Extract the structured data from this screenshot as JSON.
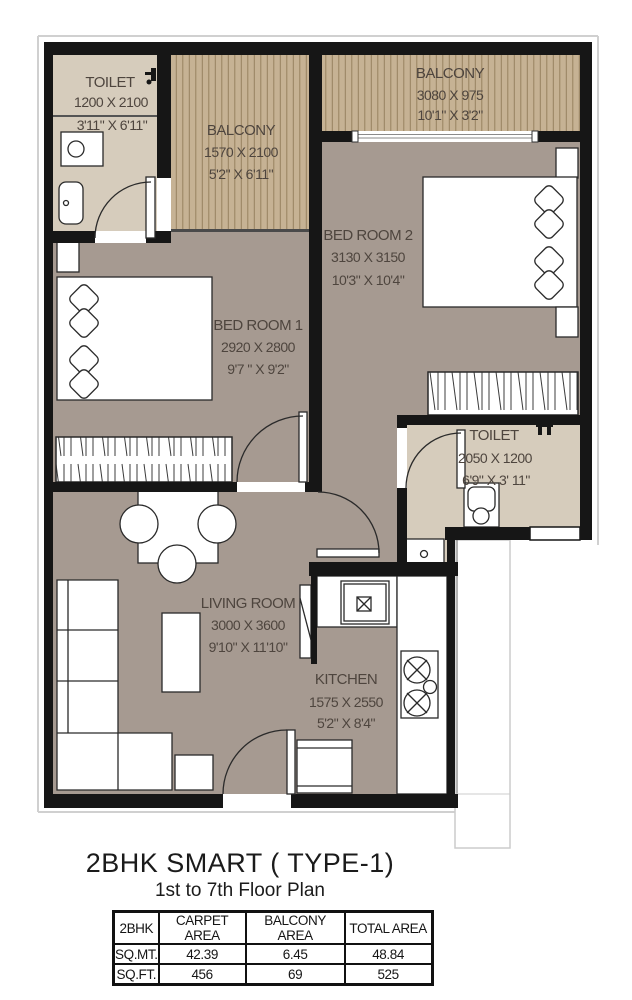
{
  "title": "2BHK SMART ( TYPE-1)",
  "subtitle": "1st to 7th Floor Plan",
  "rooms": {
    "toilet1": {
      "name": "TOILET",
      "mm": "1200 X 2100",
      "ft": "3'11\" X 6'11\""
    },
    "balcony1": {
      "name": "BALCONY",
      "mm": "1570 X 2100",
      "ft": "5'2\" X 6'11\""
    },
    "balcony2": {
      "name": "BALCONY",
      "mm": "3080 X 975",
      "ft": "10'1\" X 3'2\""
    },
    "bedroom1": {
      "name": "BED ROOM 1",
      "mm": "2920 X 2800",
      "ft": "9'7 \" X 9'2\""
    },
    "bedroom2": {
      "name": "BED ROOM 2",
      "mm": "3130 X 3150",
      "ft": "10'3\" X 10'4\""
    },
    "toilet2": {
      "name": "TOILET",
      "mm": "2050 X 1200",
      "ft": "6'9\" X 3' 11\""
    },
    "living": {
      "name": "LIVING ROOM",
      "mm": "3000 X 3600",
      "ft": "9'10\" X 11'10\""
    },
    "kitchen": {
      "name": "KITCHEN",
      "mm": "1575 X 2550",
      "ft": "5'2\" X 8'4\""
    }
  },
  "area_table": {
    "headers": [
      "2BHK",
      "CARPET AREA",
      "BALCONY AREA",
      "TOTAL AREA"
    ],
    "rows": [
      [
        "SQ.MT.",
        "42.39",
        "6.45",
        "48.84"
      ],
      [
        "SQ.FT.",
        "456",
        "69",
        "525"
      ]
    ]
  },
  "colors": {
    "floor": "#a69a91",
    "toilet_floor": "#d6ccbc",
    "balcony_floor": "#c6b294",
    "wall": "#161616",
    "label": "#4e453e"
  }
}
